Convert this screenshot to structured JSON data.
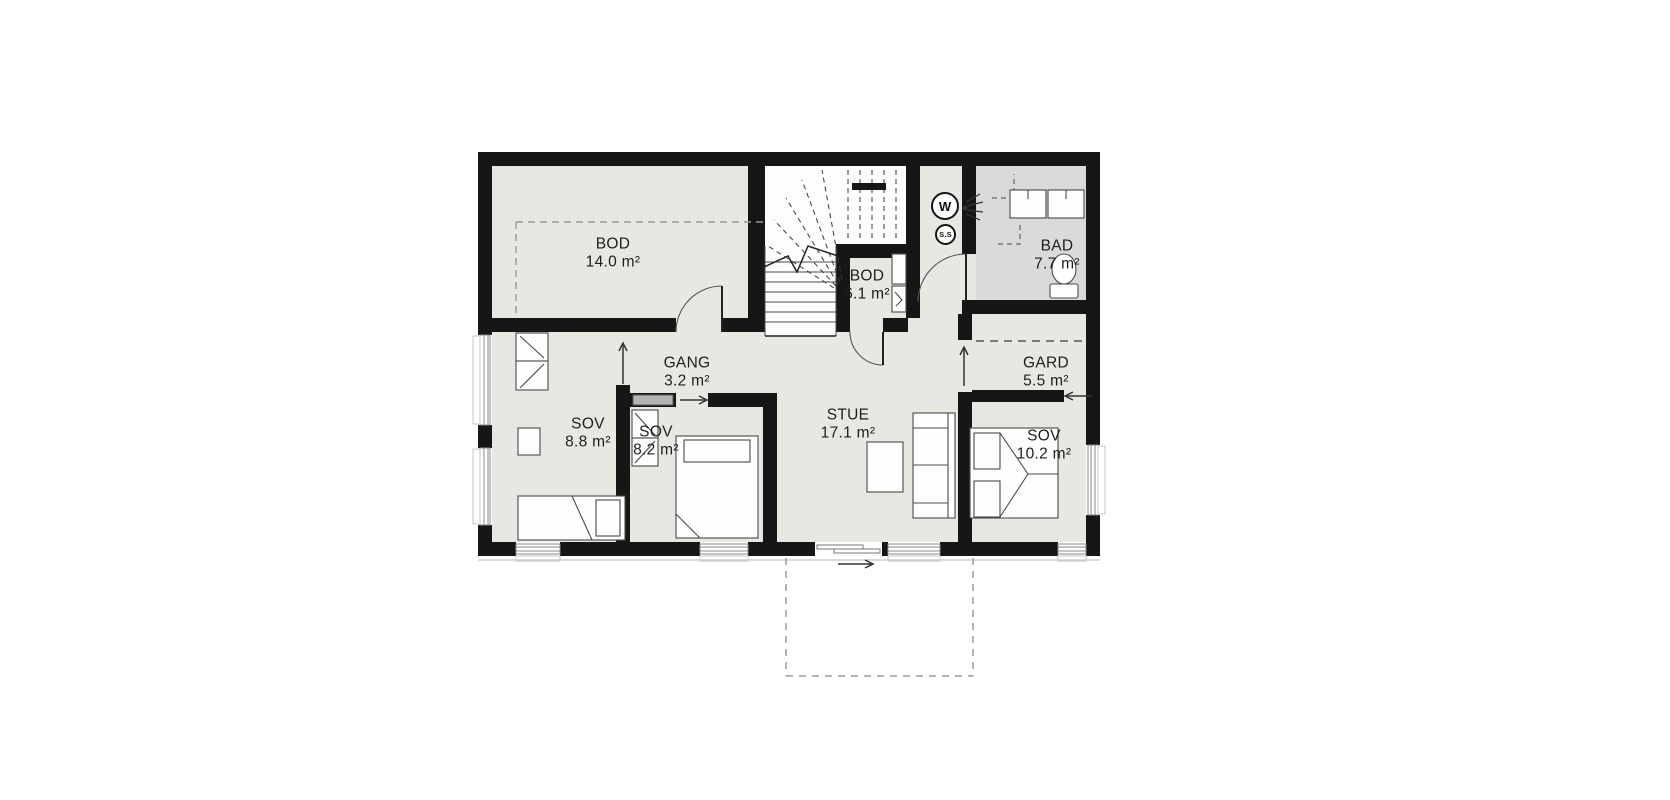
{
  "plan": {
    "type": "floor-plan",
    "rooms": [
      {
        "id": "bod14",
        "name": "BOD",
        "area": "14.0 m²"
      },
      {
        "id": "bod61",
        "name": "BOD",
        "area": "6.1 m²"
      },
      {
        "id": "bad",
        "name": "BAD",
        "area": "7.7 m²"
      },
      {
        "id": "gang",
        "name": "GANG",
        "area": "3.2 m²"
      },
      {
        "id": "gard",
        "name": "GARD",
        "area": "5.5 m²"
      },
      {
        "id": "sov88",
        "name": "SOV",
        "area": "8.8 m²"
      },
      {
        "id": "sov82",
        "name": "SOV",
        "area": "8.2 m²"
      },
      {
        "id": "stue",
        "name": "STUE",
        "area": "17.1 m²"
      },
      {
        "id": "sov102",
        "name": "SOV",
        "area": "10.2 m²"
      }
    ],
    "symbols": {
      "washer": "W",
      "hot_water_tank": "S.S"
    },
    "colors": {
      "wall": "#161616",
      "floor": "#e8e7e2",
      "bathroom": "#d9dadc",
      "stairwell": "#fdfdfd",
      "dashed_detail": "#999999",
      "furniture_stroke": "#4a4a4a"
    }
  }
}
